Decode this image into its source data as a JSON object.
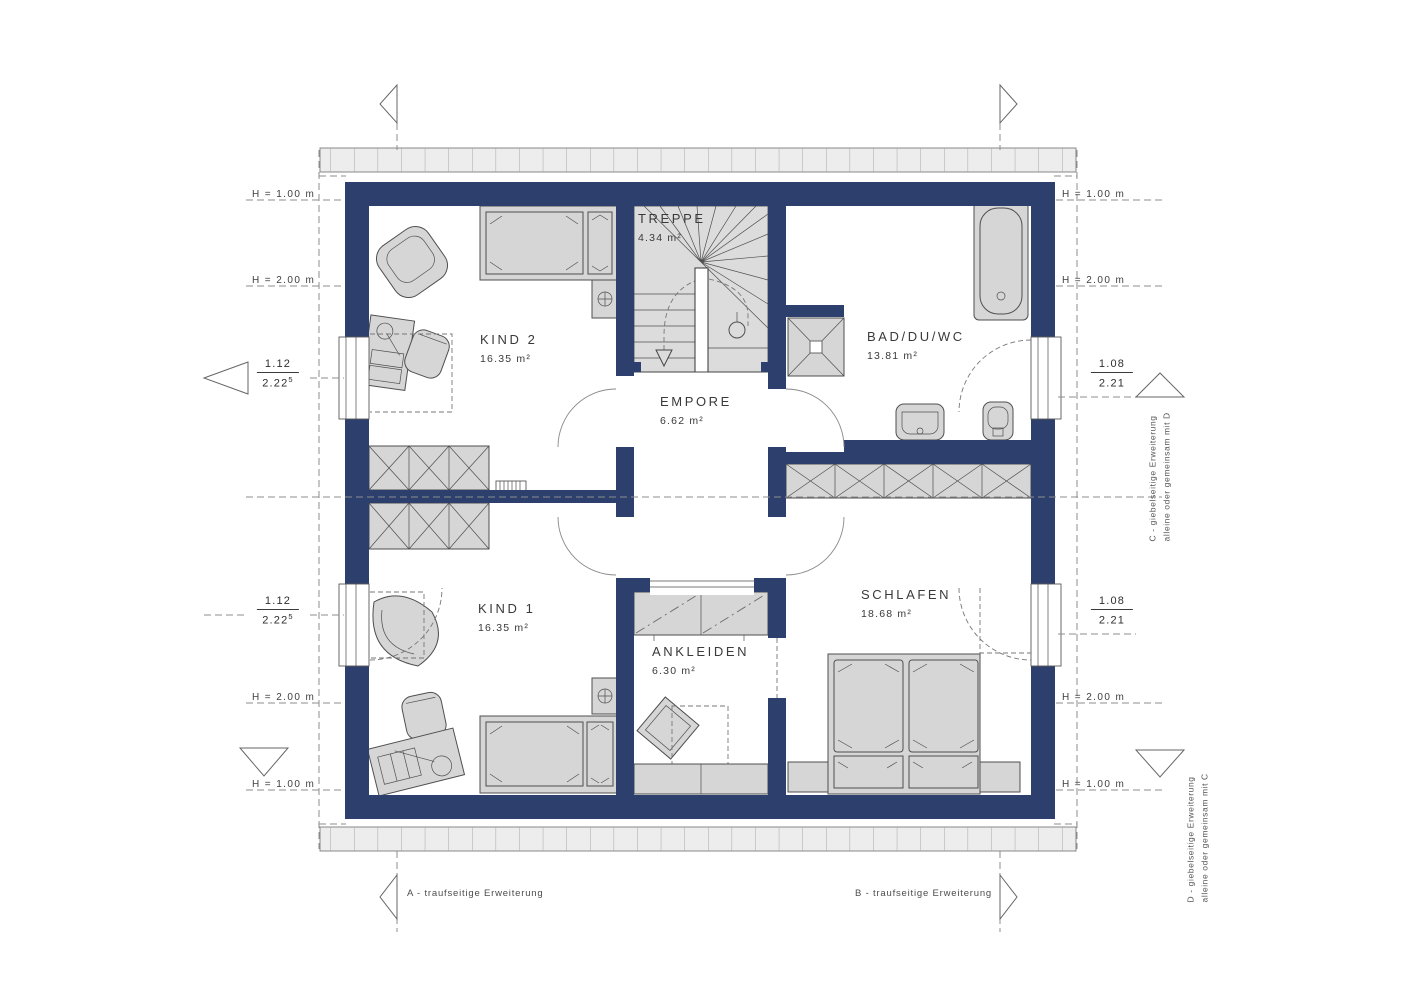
{
  "rooms": [
    {
      "name": "KIND 2",
      "area": "16.35 m²"
    },
    {
      "name": "TREPPE",
      "area": "4.34 m²"
    },
    {
      "name": "BAD/DU/WC",
      "area": "13.81 m²"
    },
    {
      "name": "EMPORE",
      "area": "6.62 m²"
    },
    {
      "name": "KIND 1",
      "area": "16.35 m²"
    },
    {
      "name": "ANKLEIDEN",
      "area": "6.30 m²"
    },
    {
      "name": "SCHLAFEN",
      "area": "18.68 m²"
    }
  ],
  "height_labels": {
    "h100": "H = 1.00 m",
    "h200": "H = 2.00 m"
  },
  "fractions": {
    "left": {
      "num": "1.12",
      "den": "2.22",
      "sup": "5"
    },
    "right": {
      "num": "1.08",
      "den": "2.21",
      "sup": ""
    }
  },
  "annotations": {
    "a": "A - traufseitige Erweiterung",
    "b": "B - traufseitige Erweiterung",
    "c1": "C - giebelseitige Erweiterung",
    "c2": "alleine oder gemeinsam mit D",
    "d1": "D - giebelseitige Erweiterung",
    "d2": "alleine oder gemeinsam mit C"
  },
  "colors": {
    "wall": "#2d3f6d",
    "furniture": "#d6d6d6",
    "stair_fill": "#dcdcdc",
    "roof_band": "#ededed"
  }
}
